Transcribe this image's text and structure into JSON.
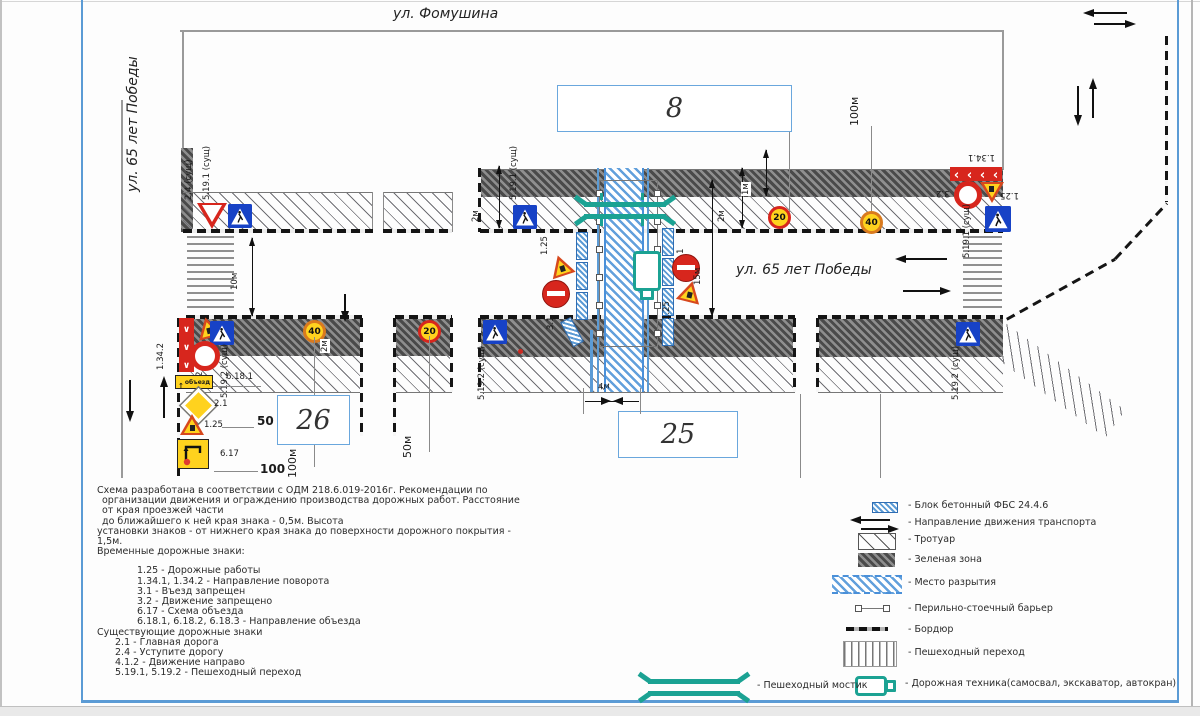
{
  "streets": {
    "top": "ул. Фомушина",
    "left": "ул. 65 лет Победы",
    "center": "ул. 65 лет Победы"
  },
  "buildings": {
    "b8": "8",
    "b25": "25",
    "b26": "26"
  },
  "dims": {
    "m10": "10м",
    "m2": "2м",
    "m1": "1м",
    "m4": "4м",
    "m15": "15м",
    "m50": "50м",
    "m100": "100м",
    "n50": "50",
    "n100": "100"
  },
  "signs": {
    "s24": "2.4 (сущ)",
    "s5191": "5.19.1 (сущ)",
    "s5192": "5.19.2 (сущ)",
    "s125": "1.25",
    "s31": "3.1",
    "s32": "3.2",
    "s21": "2.1",
    "s617": "6.17",
    "s6181": "6.18.1",
    "s1341": "1.34.1",
    "s1342": "1.34.2",
    "speed20": "20",
    "speed40": "40",
    "detour": "объезд"
  },
  "notes": {
    "lines": [
      "Схема разработана в соответствии с ОДМ 218.6.019-2016г. Рекомендации по",
      "организации движения и ограждению производства дорожных работ. Расстояние",
      "от края проезжей части",
      "до ближайшего к ней края знака - 0,5м. Высота",
      "установки знаков - от нижнего края знака до поверхности дорожного покрытия - 1,5м.",
      "Временные дорожные знаки:",
      "1.25 - Дорожные работы",
      "1.34.1, 1.34.2 - Направление поворота",
      "3.1 - Въезд запрещен",
      "3.2 - Движение запрещено",
      "6.17 - Схема объезда",
      "6.18.1, 6.18.2, 6.18.3 - Направление объезда",
      "Существующие дорожные знаки",
      "2.1 - Главная дорога",
      "2.4 - Уступите дорогу",
      "4.1.2 - Движение направо",
      "5.19.1, 5.19.2 - Пешеходный переход"
    ]
  },
  "legend": {
    "items": [
      "- Блок бетонный ФБС 24.4.6",
      "- Направление движения транспорта",
      "- Тротуар",
      "- Зеленая зона",
      "- Место разрытия",
      "- Перильно-стоечный барьер",
      "- Бордюр",
      "- Пешеходный переход",
      "- Дорожная техника(самосвал, экскаватор, автокран)"
    ],
    "bridge": "- Пешеходный мостик"
  },
  "colors": {
    "frame_blue": "#5b9bd5",
    "trench_blue": "#4a90d9",
    "teal": "#1ba293",
    "sign_red": "#d7261d",
    "sign_blue": "#1742c6",
    "sign_yellow": "#ffd21e"
  }
}
